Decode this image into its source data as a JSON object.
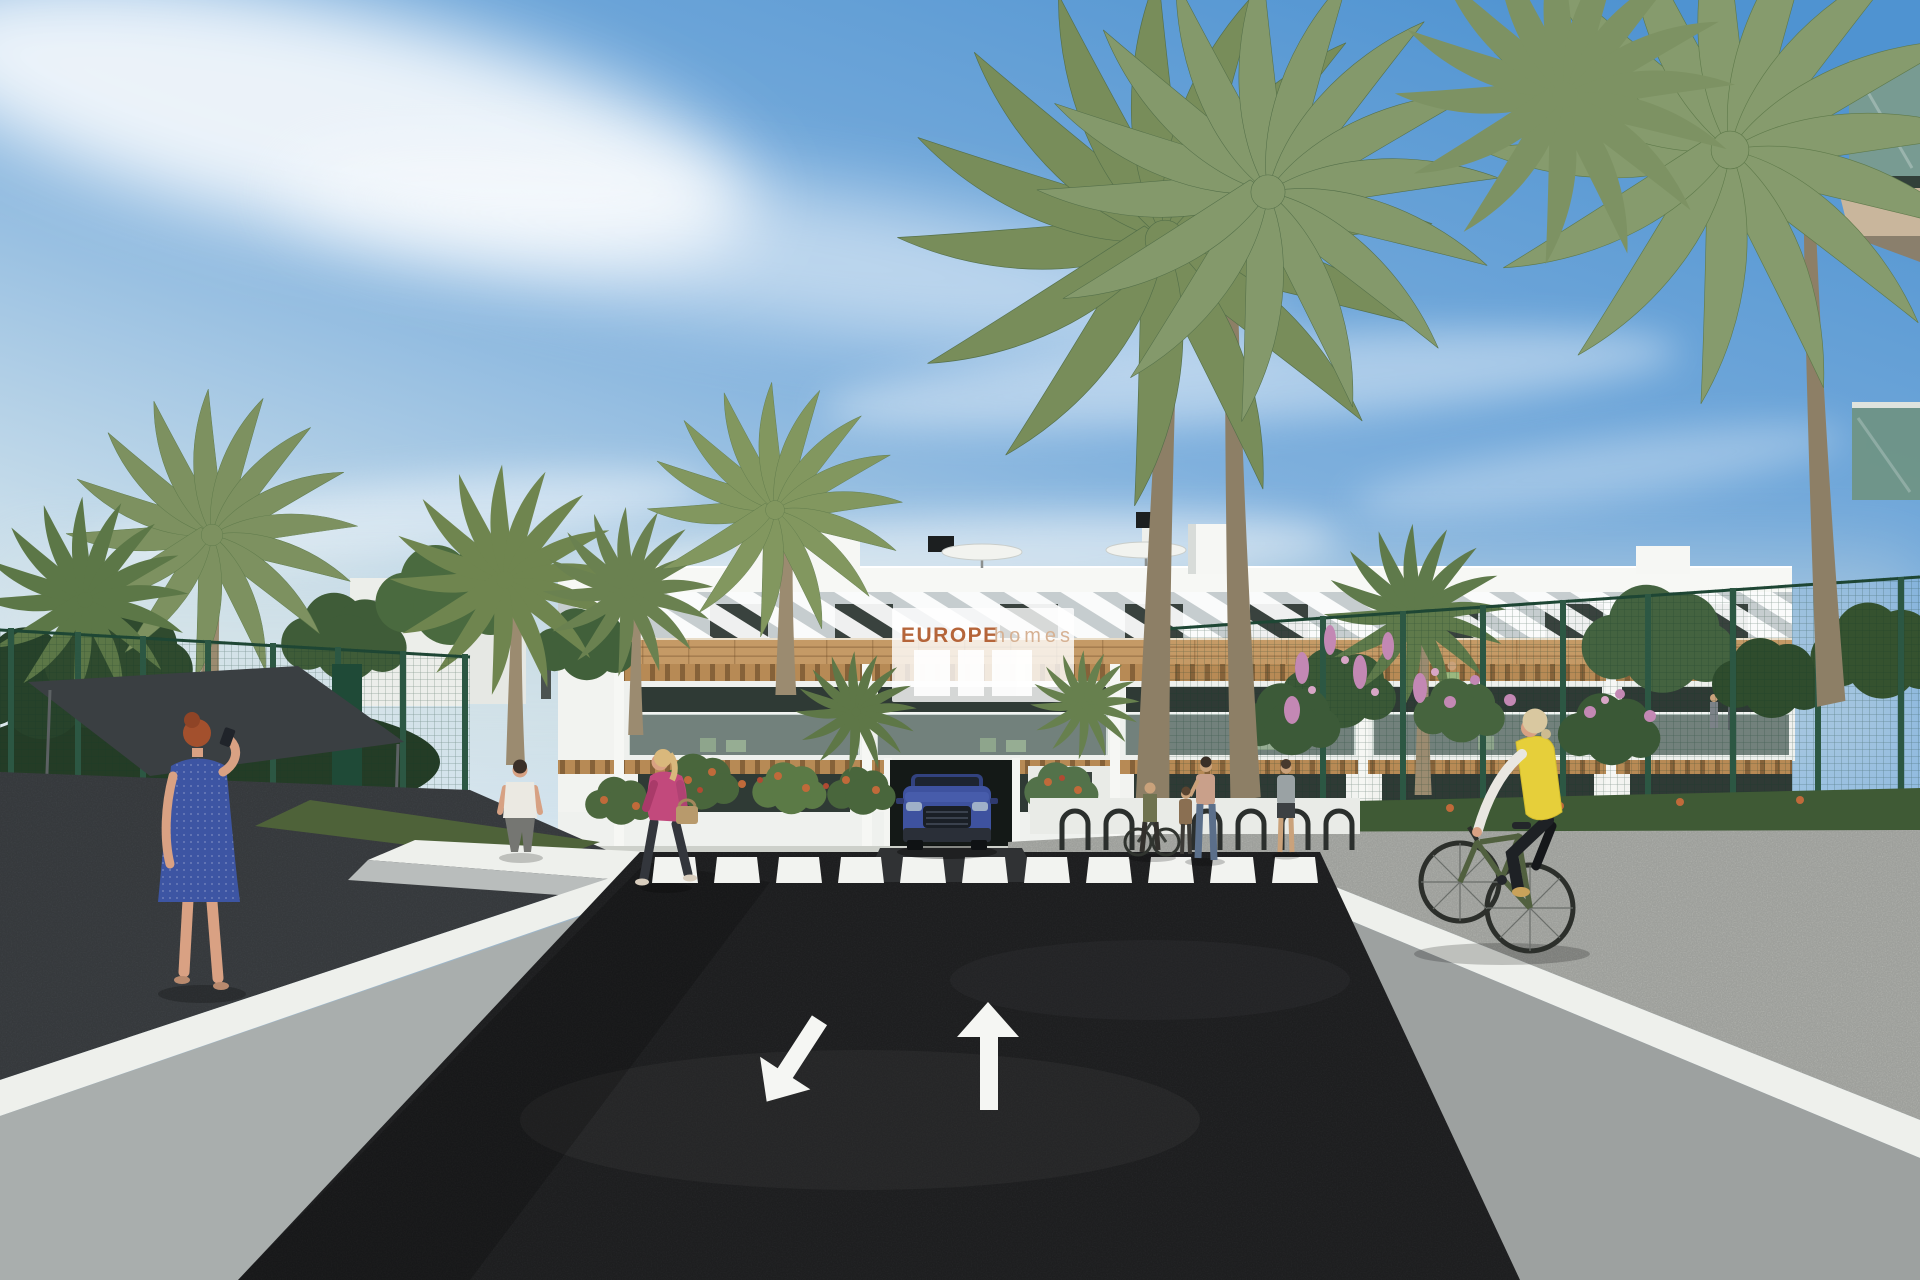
{
  "scene": {
    "type": "3d-architectural-rendering",
    "setting": "Modern white apartment complex street view with palm trees, pedestrians and cyclist",
    "elements": [
      "apartment building",
      "developer banner sign",
      "two-way access road",
      "pedestrian crossing",
      "road direction arrows",
      "garage entrance with blue SUV",
      "palm trees",
      "green mesh fences",
      "dark shade sail",
      "pedestrians",
      "cyclist in yellow vest",
      "bike racks",
      "flower beds"
    ]
  },
  "sign": {
    "brand": "EUROPE",
    "suffix": "homes"
  },
  "road": {
    "crosswalk_stripe_count": 11,
    "lane_arrows": [
      "toward-viewer",
      "away-from-viewer"
    ]
  },
  "colors": {
    "sky_top": "#4f93d1",
    "sky_mid": "#7fb0dd",
    "sky_low": "#c6dcea",
    "horizon": "#e4edf2",
    "cloud": "#ffffff",
    "building": "#f2f3f0",
    "attic": "#c6cdcf",
    "wood": "#c59a66",
    "glass": "#2f3a35",
    "sign_bg": "#ffffff",
    "brand_orange": "#b5653a",
    "brand_tan": "#d6b193",
    "asphalt": "#2b2c2e",
    "crosswalk": "#f2f3f0",
    "arrow": "#f5f6f3",
    "wall": "#eef0ec",
    "wall_shade": "#a9aead",
    "pavement": "#bdbfba",
    "lawn": "#4e6239",
    "fence": "#2c5743",
    "palm": "#7d9160",
    "foliage": "#3f5c38",
    "trunk": "#9b8b70",
    "flower_pink": "#c388b4",
    "flower_orange": "#c06a3a",
    "canopy": "#3a3f42",
    "car": "#3e529f",
    "garage": "#141917",
    "dress_blue": "#3d55a3",
    "hair_red": "#a3502d",
    "skin": "#d9a183",
    "vest_yellow": "#e6cf3a",
    "jacket_pink": "#c2497c",
    "bike_green": "#51603f",
    "shirt_white": "#ebe9e2"
  }
}
